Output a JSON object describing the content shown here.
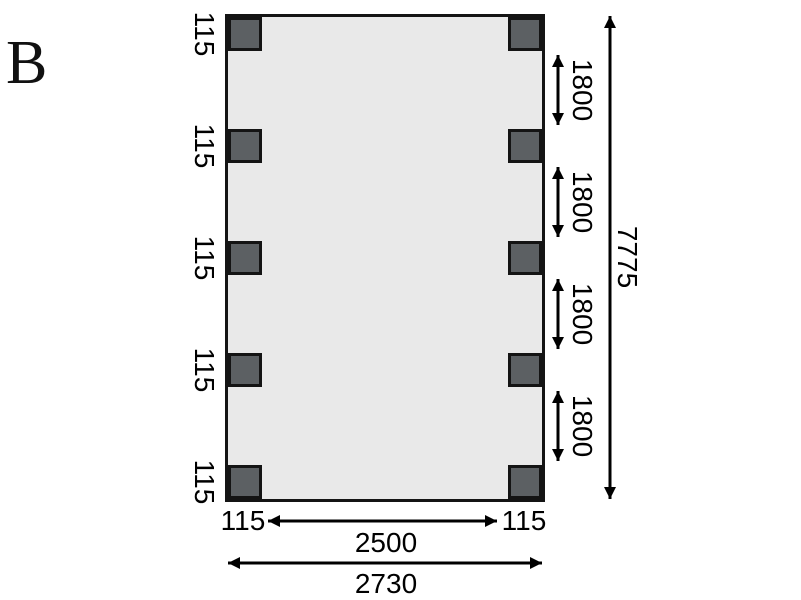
{
  "figure": {
    "label": "B"
  },
  "plan": {
    "left_post_width_labels": [
      "115",
      "115",
      "115",
      "115",
      "115"
    ],
    "right_post_spacing_labels": [
      "1800",
      "1800",
      "1800",
      "1800"
    ],
    "total_height_label": "7775",
    "bottom_left_post_label": "115",
    "bottom_right_post_label": "115",
    "inner_width_label": "2500",
    "total_width_label": "2730"
  },
  "colors": {
    "plan_fill": "#e9e9e9",
    "post_fill": "#5c6063",
    "line": "#000000"
  }
}
